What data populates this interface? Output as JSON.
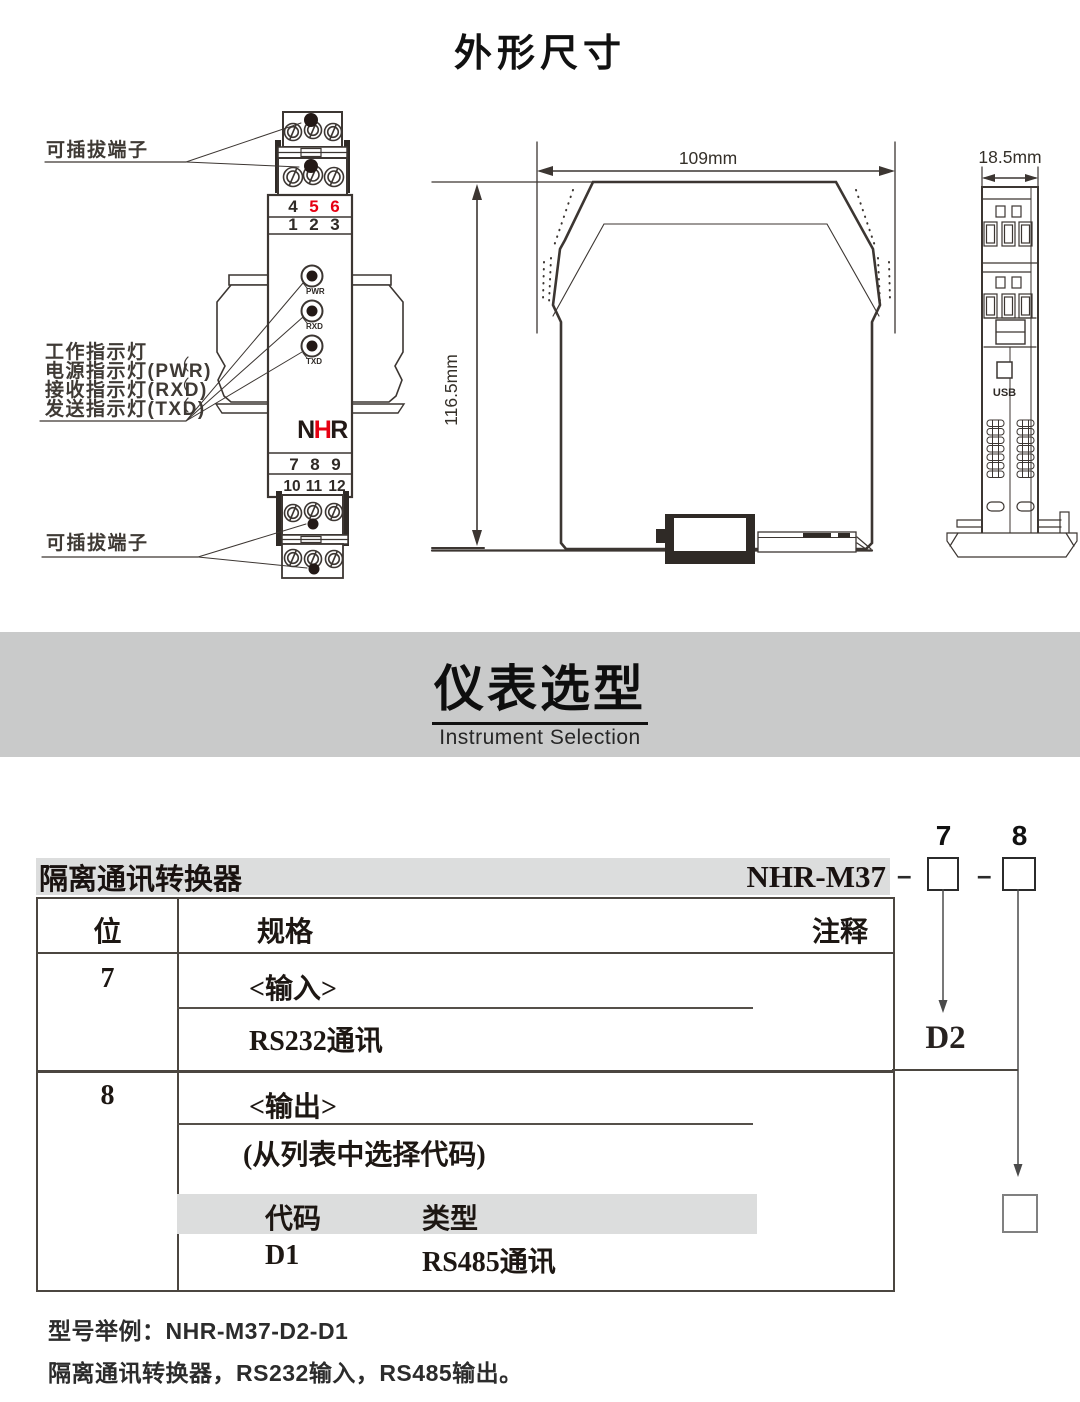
{
  "colors": {
    "red": "#e60012",
    "banner_bg": "#c9caca",
    "bar_bg": "#dcdddd",
    "ink": "#231916"
  },
  "sections": {
    "dimensions_title": "外形尺寸",
    "selection_title": "仪表选型",
    "selection_subtitle": "Instrument Selection"
  },
  "front_view": {
    "pluggable_top": "可插拔端子",
    "pluggable_bottom": "可插拔端子",
    "indicators": [
      "工作指示灯",
      "电源指示灯(PWR)",
      "接收指示灯(RXD)",
      "发送指示灯(TXD)"
    ],
    "led_labels": [
      "PWR",
      "RXD",
      "TXD"
    ],
    "top_row1": [
      "4",
      "5",
      "6"
    ],
    "top_row2": [
      "1",
      "2",
      "3"
    ],
    "bottom_row1": [
      "7",
      "8",
      "9"
    ],
    "bottom_row2": [
      "10",
      "11",
      "12"
    ],
    "logo": {
      "n": "N",
      "h": "H",
      "r": "R"
    }
  },
  "side_view": {
    "width": "109mm",
    "height": "116.5mm"
  },
  "end_view": {
    "width": "18.5mm",
    "usb": "USB"
  },
  "selection": {
    "digit7": "7",
    "digit8": "8",
    "dash": "–",
    "product": "隔离通讯转换器",
    "model": "NHR-M37",
    "headers": {
      "pos": "位",
      "spec": "规格",
      "note": "注释"
    },
    "row7": {
      "pos": "7",
      "title": "<输入>",
      "item": "RS232通讯",
      "note": "D2"
    },
    "row8": {
      "pos": "8",
      "title": "<输出>",
      "subtitle": "(从列表中选择代码)",
      "code_header": "代码",
      "type_header": "类型",
      "code": "D1",
      "type": "RS485通讯"
    }
  },
  "footer": {
    "example": "型号举例：NHR-M37-D2-D1",
    "description": "隔离通讯转换器，RS232输入，RS485输出。"
  }
}
